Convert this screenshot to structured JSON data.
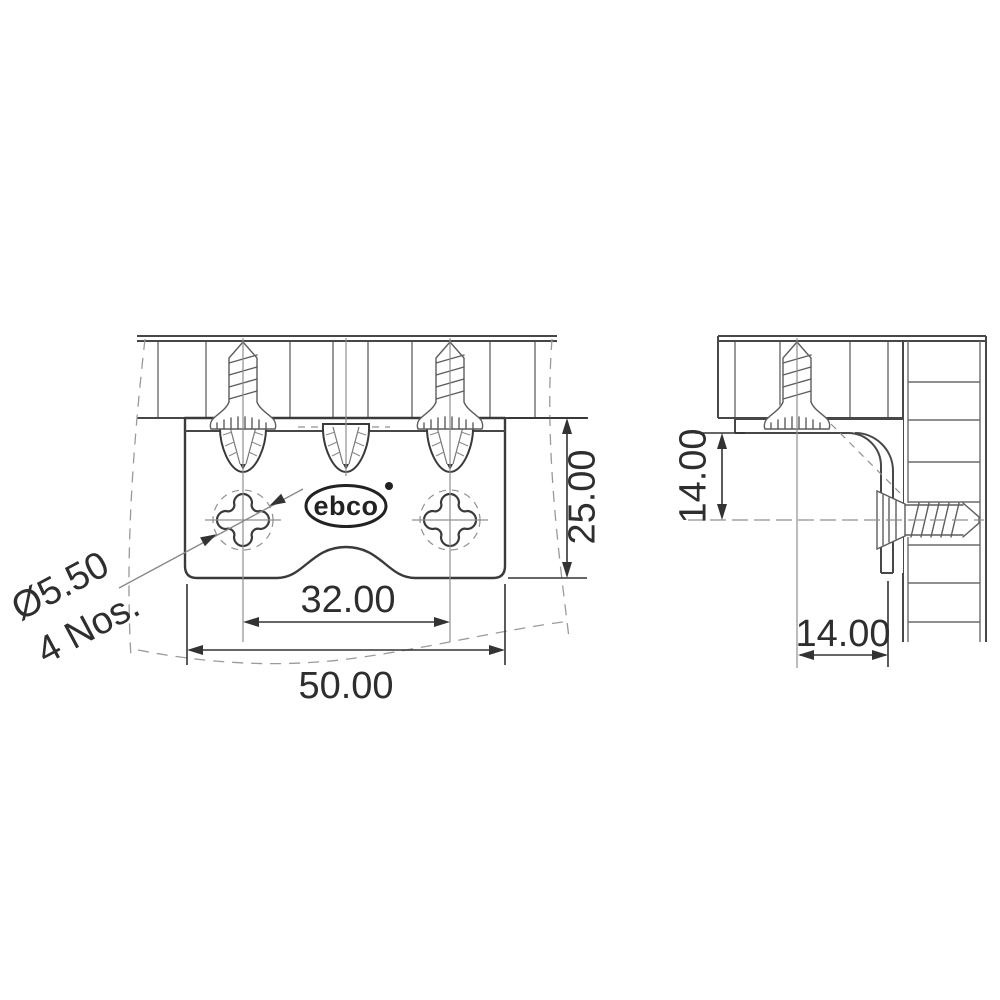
{
  "drawing": {
    "brand": "ebco",
    "colors": {
      "background": "#ffffff",
      "line": "#3a3a3a",
      "text": "#2e2e2e"
    },
    "front_view": {
      "dim_height": "25.00",
      "dim_hole_spacing": "32.00",
      "dim_width": "50.00",
      "hole_callout_line1": "Ø5.50",
      "hole_callout_line2": "4 Nos."
    },
    "side_view": {
      "dim_vertical": "14.00",
      "dim_horizontal": "14.00"
    }
  }
}
